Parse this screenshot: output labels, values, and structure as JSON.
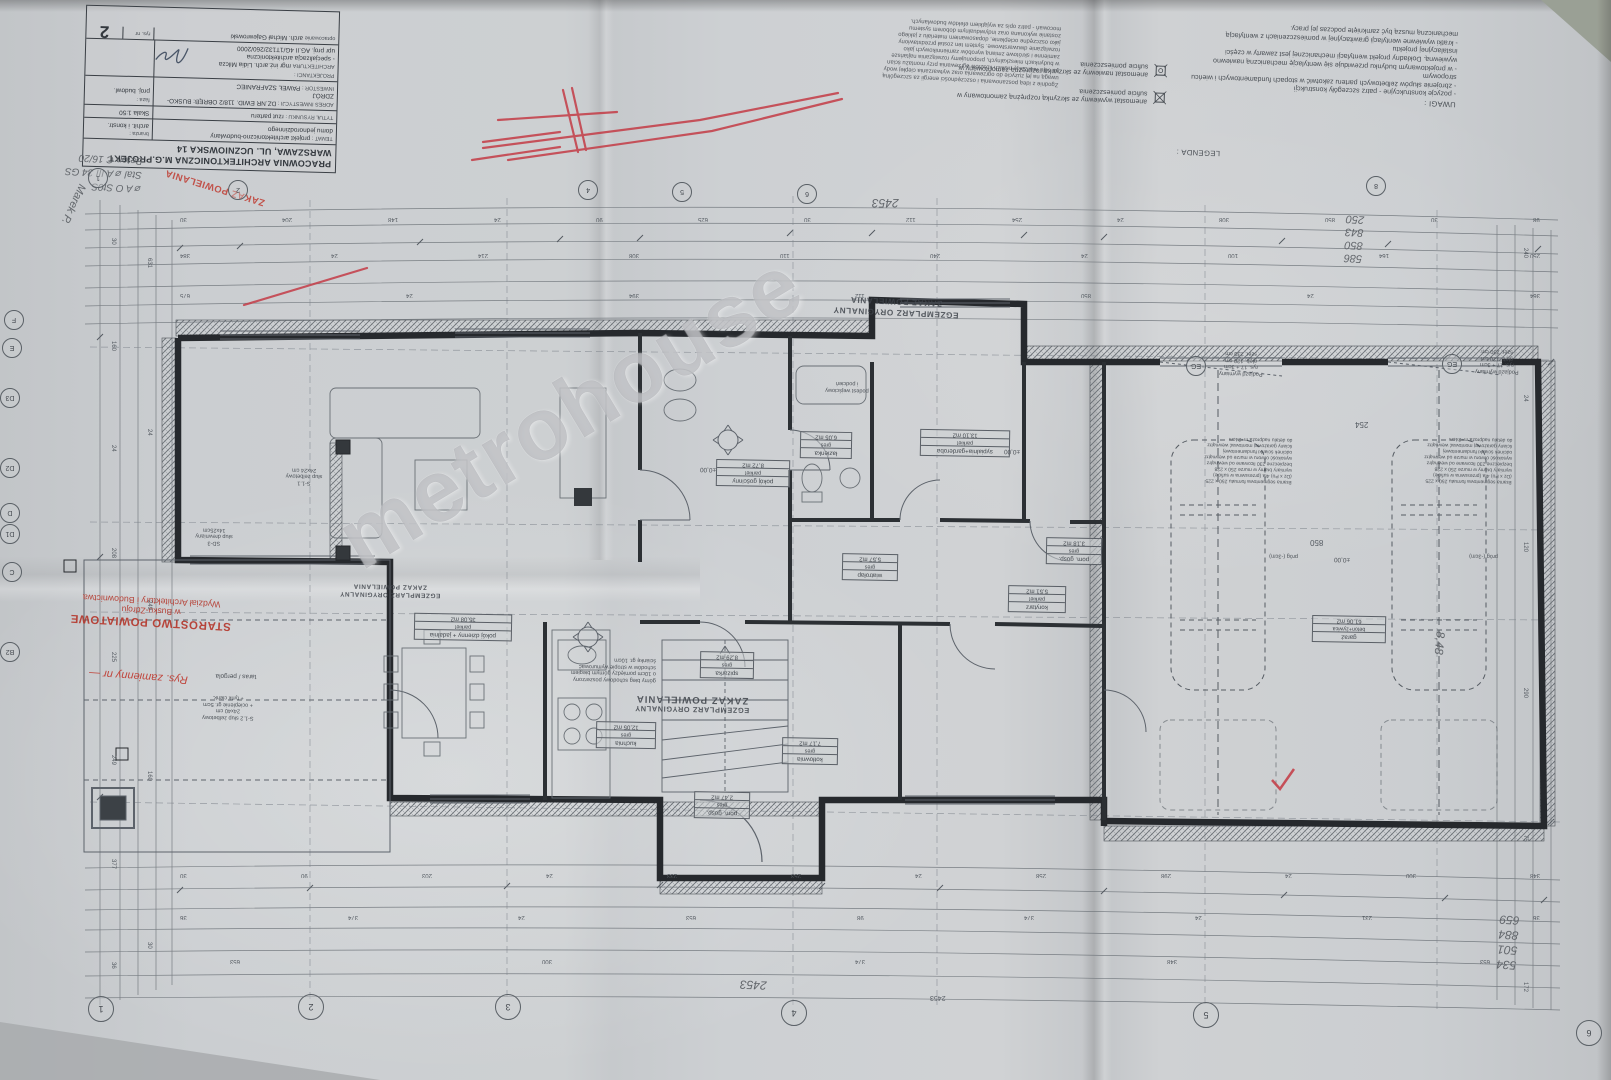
{
  "watermark": "metrohouse",
  "title_block": {
    "office": "PRACOWNIA ARCHITEKTONICZNA M.G.PROJEKT",
    "office_address": "WARSZAWA, UL. UCZNIOWSKA 14",
    "temat_label": "TEMAT :",
    "temat_1": "projekt architektoniczno-budowlany",
    "temat_2": "domu jednorodzinnego",
    "branza_label": "branża :",
    "branza": "archit. i konstr.",
    "tytul_label": "TYTUŁ RYSUNKU :",
    "tytul": "rzut parteru",
    "skala": "Skala 1:50",
    "adres_label": "ADRES INWESTYCJI :",
    "adres": "DZ.NR EWID. 118/2 OBRĘB: BUSKO-ZDRÓJ",
    "faza_label": "faza :",
    "faza": "proj. budowl.",
    "inwestor_label": "INWESTOR :",
    "inwestor": "PAWEŁ SZAFRANIEC",
    "projektanci_label": "PROJEKTANCI :",
    "arch_label": "ARCHITEKTURA",
    "arch_name": "mgr inż.arch. Lidia Milcza",
    "arch_spec": "- specjalizacja architektoniczna",
    "arch_upr": "upr proj. AG.II 4G/1T132/260/2000",
    "oprac_label": "opracowanie",
    "oprac": "arch. Michał Gajewrowski",
    "rysnr_label": "rys. nr",
    "rysnr": "2"
  },
  "uwagi": {
    "title": "UWAGI :",
    "items": [
      "- pozycje konstrukcyjne - patrz szczegóły konstrukcji",
      "- zbrojenie słupów żelbetowych parteru zakotwić w stopach fundamentowych i wieńcu stropowym",
      "- w projektowanym budynku przewiduje się wentylację mechaniczną nawiewno wywiewną. Dokładny projekt wentylacji mechanicznej jest zawarty w części instalacyjnej projektu",
      "- kratki wywiewne wentylacji grawitacyjnej w pomieszczeniach z wentylacją mechaniczną muszą być zamknięte podczas jej pracy."
    ]
  },
  "legenda": {
    "title": "LEGENDA :",
    "items": [
      "anemostat wywiewny ze skrzynką rozprężną zamontowany w suficie pomieszczenia",
      "anemostat nawiewny ze skrzynką rozprężną zamontowany w suficie pomieszczenia"
    ]
  },
  "energy_note": [
    "Zgodnie z ideą poszanowania i oszczędności energii za szczególną",
    "uwagą na jej zużycie do ogrzewania oraz wytwarzania ciepłej wody",
    "na celu realizację niskich kosztów ogrzewania przy montażu ścian",
    "w budynkach mieszkalnych, proponujemy rozwiązania najtańsze",
    "zamienne i skrótowe zmianą wyrobów zamiennikowych jako",
    "rozwiązanie dwuwarstwowe. System ten został przedstawiony",
    "jako oszczędne ocieplenie, dopasowaniem materiału z jakiego",
    "zostanie wykonana oraz indywidualnym doborem systemu",
    "mocowań - patrz opis za wyjątkiem efektów budowlanych."
  ],
  "stamps": {
    "original_l1": "EGZEMPLARZ ORYGINALNY",
    "original_l2": "ZAKAZ POWIELANIA",
    "zakaz_red": "ZAKAZ POWIELANIA",
    "starostwo_l1": "STAROSTWO POWIATOWE",
    "starostwo_l2": "w Busku-Zdroju",
    "starostwo_l3": "Wydział Architektury i Budownictwa",
    "rys_zamienny": "Rys. zamienny nr —"
  },
  "handwritten": {
    "beton": [
      "Beton C 16/20",
      "Stal ⌀ A III 34 GS",
      "⌀ A O  St0S"
    ],
    "name": "Marek P.",
    "n_2453": "2453",
    "stack_top_right": [
      "586",
      "850",
      "843",
      "250"
    ],
    "stack_bottom_right": [
      "534",
      "501",
      "884",
      "659"
    ],
    "n_848": "8,48",
    "total_bottom": "2453"
  },
  "rooms": [
    {
      "name": "pokój dzienny + jadalnia",
      "floor": "parkiet",
      "area": "35,08 m2"
    },
    {
      "name": "kuchnia",
      "floor": "gres",
      "area": "12,05 m2"
    },
    {
      "name": "pokój gościnny",
      "floor": "parkiet",
      "area": "8,72 m2"
    },
    {
      "name": "sypialnia+garderoba",
      "floor": "parkiet",
      "area": "13,10 m2"
    },
    {
      "name": "łazienka",
      "floor": "gres",
      "area": "6,05 m2"
    },
    {
      "name": "korytarz",
      "floor": "parkiet",
      "area": "5,51 m2"
    },
    {
      "name": "pom. gosp.",
      "floor": "gres",
      "area": "3,18 m2"
    },
    {
      "name": "pom. gosp.",
      "floor": "gres",
      "area": "2,47 m2"
    },
    {
      "name": "kotłownia",
      "floor": "gres",
      "area": "7,17 m2"
    },
    {
      "name": "wiatrołap",
      "floor": "gres",
      "area": "5,57 m2"
    },
    {
      "name": "garaż",
      "floor": "beton+żywica",
      "area": "61,06 m2"
    },
    {
      "name": "spiżarka",
      "floor": "gres",
      "area": "8,29 m2"
    }
  ],
  "labels": {
    "podjazd": [
      "Podjazd wymiany",
      "rys. 17 + 3cm",
      "głęb. 120 cm",
      "szer. 230 cm"
    ],
    "eg": "EG",
    "prog": "próg (-3cm)",
    "taras": "taras / pergola",
    "podest_1": "podest wejściowy",
    "podest_2": "i podcień",
    "level": "±0,00",
    "stairs_note": [
      "górny bieg schodowy poszerzony",
      "o 10cm pomiędzy górnym biegiem",
      "schodów w stropie wymurować",
      "ściankę gr. 10cm"
    ],
    "garage_note": [
      "Brama segmentowa formatu 250 x 225",
      "(Dz x Po) 4ta (przesuwna w suficie)",
      "wymiary bramy w murze 250 x 228",
      "bezpieczne 230 licowane od wewnątrz",
      "wysokość otworu w murze od wewnątrz",
      "odcinek ścianki fundamentowej",
      "ściany garażowej montować wewnątrz",
      "do detalu nadproża m=24cm"
    ],
    "s11": [
      "S-1.1",
      "słup żelbetowy",
      "24x24 cm"
    ],
    "sd3": [
      "SD-3",
      "słup drewniany",
      "14x25cm"
    ],
    "s12": [
      "S-1.2 słup żelbetowy",
      "24x40 cm",
      "+ ocieplenie gr. 5cm",
      "+ tynk cienk."
    ]
  },
  "axes": {
    "bottom": [
      "1",
      "2",
      "3",
      "4",
      "5",
      "6"
    ],
    "top": [
      "1",
      "2",
      "4",
      "5",
      "6",
      "8"
    ],
    "left": [
      "F",
      "E",
      "D3",
      "D2",
      "D",
      "D1",
      "C",
      "B2"
    ]
  },
  "dims": {
    "top1": [
      "30",
      "204",
      "148",
      "24",
      "90",
      "625",
      "30",
      "112",
      "254",
      "24",
      "308",
      "850",
      "30",
      "98"
    ],
    "top2": [
      "384",
      "24",
      "214",
      "308",
      "110",
      "240",
      "24",
      "100",
      "164",
      "250"
    ],
    "top3": [
      "675",
      "24",
      "394",
      "112",
      "850",
      "24",
      "364"
    ],
    "bottom1": [
      "30",
      "90",
      "203",
      "24",
      "233",
      "253",
      "24",
      "258",
      "298",
      "24",
      "300",
      "348"
    ],
    "bottom2": [
      "36",
      "374",
      "24",
      "653",
      "98",
      "374",
      "24",
      "231",
      "36"
    ],
    "bottom3": [
      "653",
      "300",
      "374",
      "348",
      "653"
    ],
    "left": [
      "30",
      "160",
      "24",
      "208",
      "225",
      "249",
      "377",
      "36"
    ],
    "left2": [
      "631",
      "24",
      "249",
      "160",
      "30"
    ],
    "right": [
      "240",
      "24",
      "120",
      "290",
      "75",
      "172"
    ],
    "total": "2453",
    "garage_w": "850",
    "garage_d": "254"
  }
}
